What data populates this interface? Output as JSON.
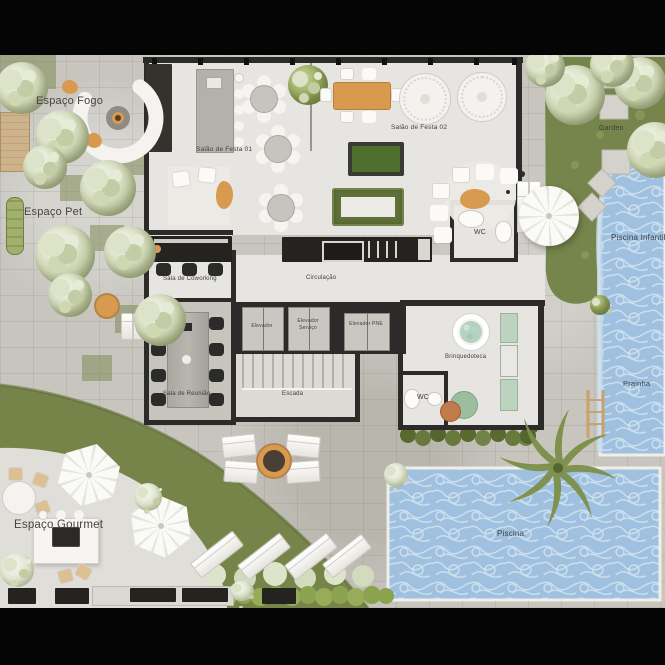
{
  "theme": {
    "stone": "#c7c5be",
    "floor": "#e6e5e1",
    "wall": "#2c2b29",
    "grass": "#77844a",
    "grass_dark": "#5d6b35",
    "water": "#9fc0de",
    "water_line": "#d3e4f1",
    "accent": "#d89a4f",
    "felt": "#4e6e2e",
    "label": "#3f3e3c"
  },
  "plan": {
    "areas": {
      "espaco_fogo": "Espaço Fogo",
      "espaco_pet": "Espaço Pet",
      "salao_festa_01": "Salão de Festa 01",
      "salao_festa_02": "Salão de Festa 02",
      "sala_coworking": "Sala de Coworking",
      "sala_reuniao": "Sala de Reunião",
      "circulacao": "Circulação",
      "elevador": "Elevador",
      "elevador_servico": "Elevador Serviço",
      "elevador_pne": "Elevador PNE",
      "escada": "Escada",
      "wc_festa": "WC",
      "wc_brinquedoteca": "WC",
      "brinquedoteca": "Brinquedoteca",
      "garden": "Garden",
      "piscina_infantil": "Piscina Infantil",
      "prainha": "Prainha",
      "piscina": "Piscina",
      "espaco_gourmet": "Espaço Gourmet"
    }
  }
}
